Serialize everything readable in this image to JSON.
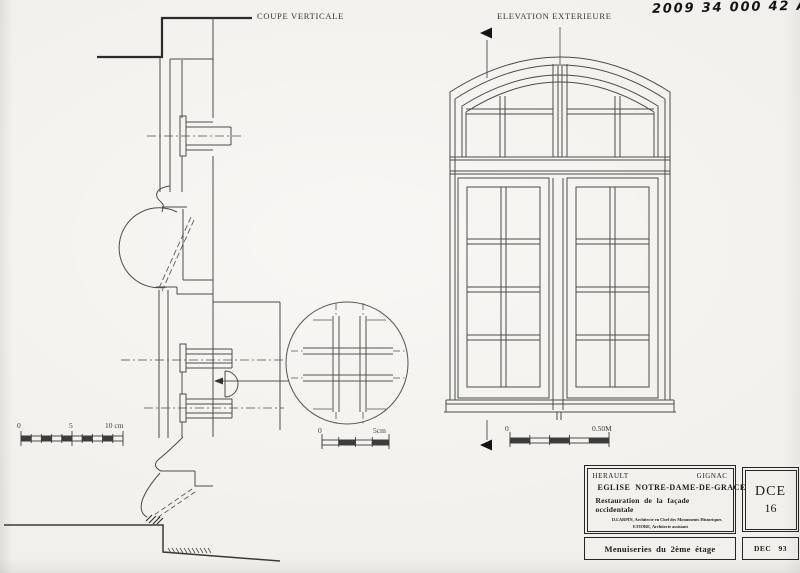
{
  "colors": {
    "paper": "#f2f0ec",
    "ink": "#4c4c4a",
    "dark_ink": "#262624"
  },
  "annotations": {
    "handwritten_reference": "2009 34 000 42 A34"
  },
  "drawings": {
    "section": {
      "label": "COUPE VERTICALE"
    },
    "elevation": {
      "label": "ELEVATION EXTERIEURE"
    }
  },
  "scales": {
    "section_scale": {
      "ticks": [
        "0",
        "5",
        "10 cm"
      ]
    },
    "detail_scale": {
      "ticks": [
        "0",
        "5cm"
      ]
    },
    "elevation_scale": {
      "ticks": [
        "0",
        "0.50M"
      ]
    }
  },
  "title_block": {
    "department": "HERAULT",
    "commune": "GIGNAC",
    "building": "EGLISE  NOTRE-DAME-DE-GRACE",
    "project": "Restauration de la façade occidentale",
    "architects": [
      "D.LARPIN, Architecte en Chef des Monuments Historiques",
      "F.FIORE, Architecte assistant"
    ],
    "doc_code": "DCE",
    "doc_number": "16",
    "sheet_title": "Menuiseries du 2ème étage",
    "date": "DEC   93"
  }
}
